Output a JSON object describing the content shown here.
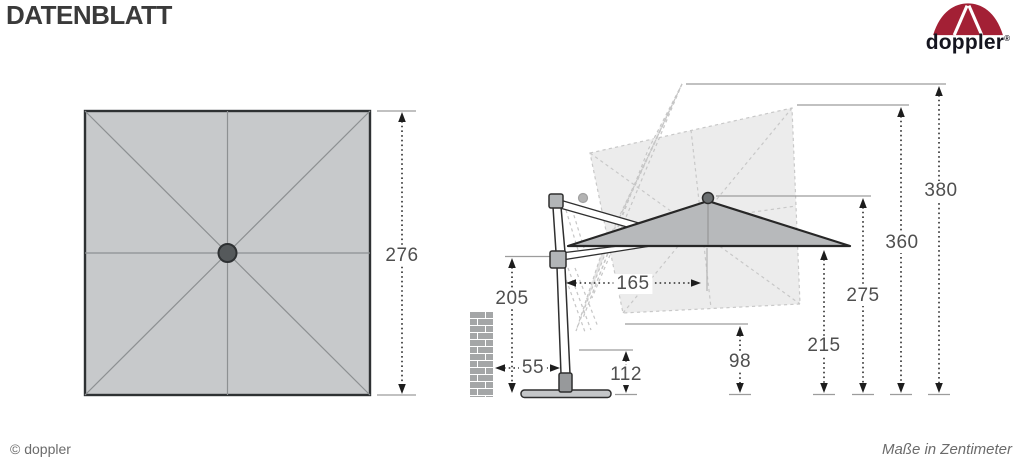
{
  "header": {
    "title": "DATENBLATT"
  },
  "logo": {
    "brand": "doppler",
    "registered": "®",
    "umbrella_red": "#a32035",
    "wordmark_color": "#15151f"
  },
  "footer": {
    "copyright": "© doppler",
    "units_note": "Maße in Zentimeter"
  },
  "dimensions_cm": {
    "d276": "276",
    "d205": "205",
    "d55": "55",
    "d112": "112",
    "d165": "165",
    "d98": "98",
    "d215": "215",
    "d275": "275",
    "d360": "360",
    "d380": "380"
  },
  "colors": {
    "canopy_fill": "#b7b9bb",
    "top_view_fill": "#c7c9cb",
    "ghost_fill": "#ececec",
    "dim_text": "#4f4f4f"
  }
}
